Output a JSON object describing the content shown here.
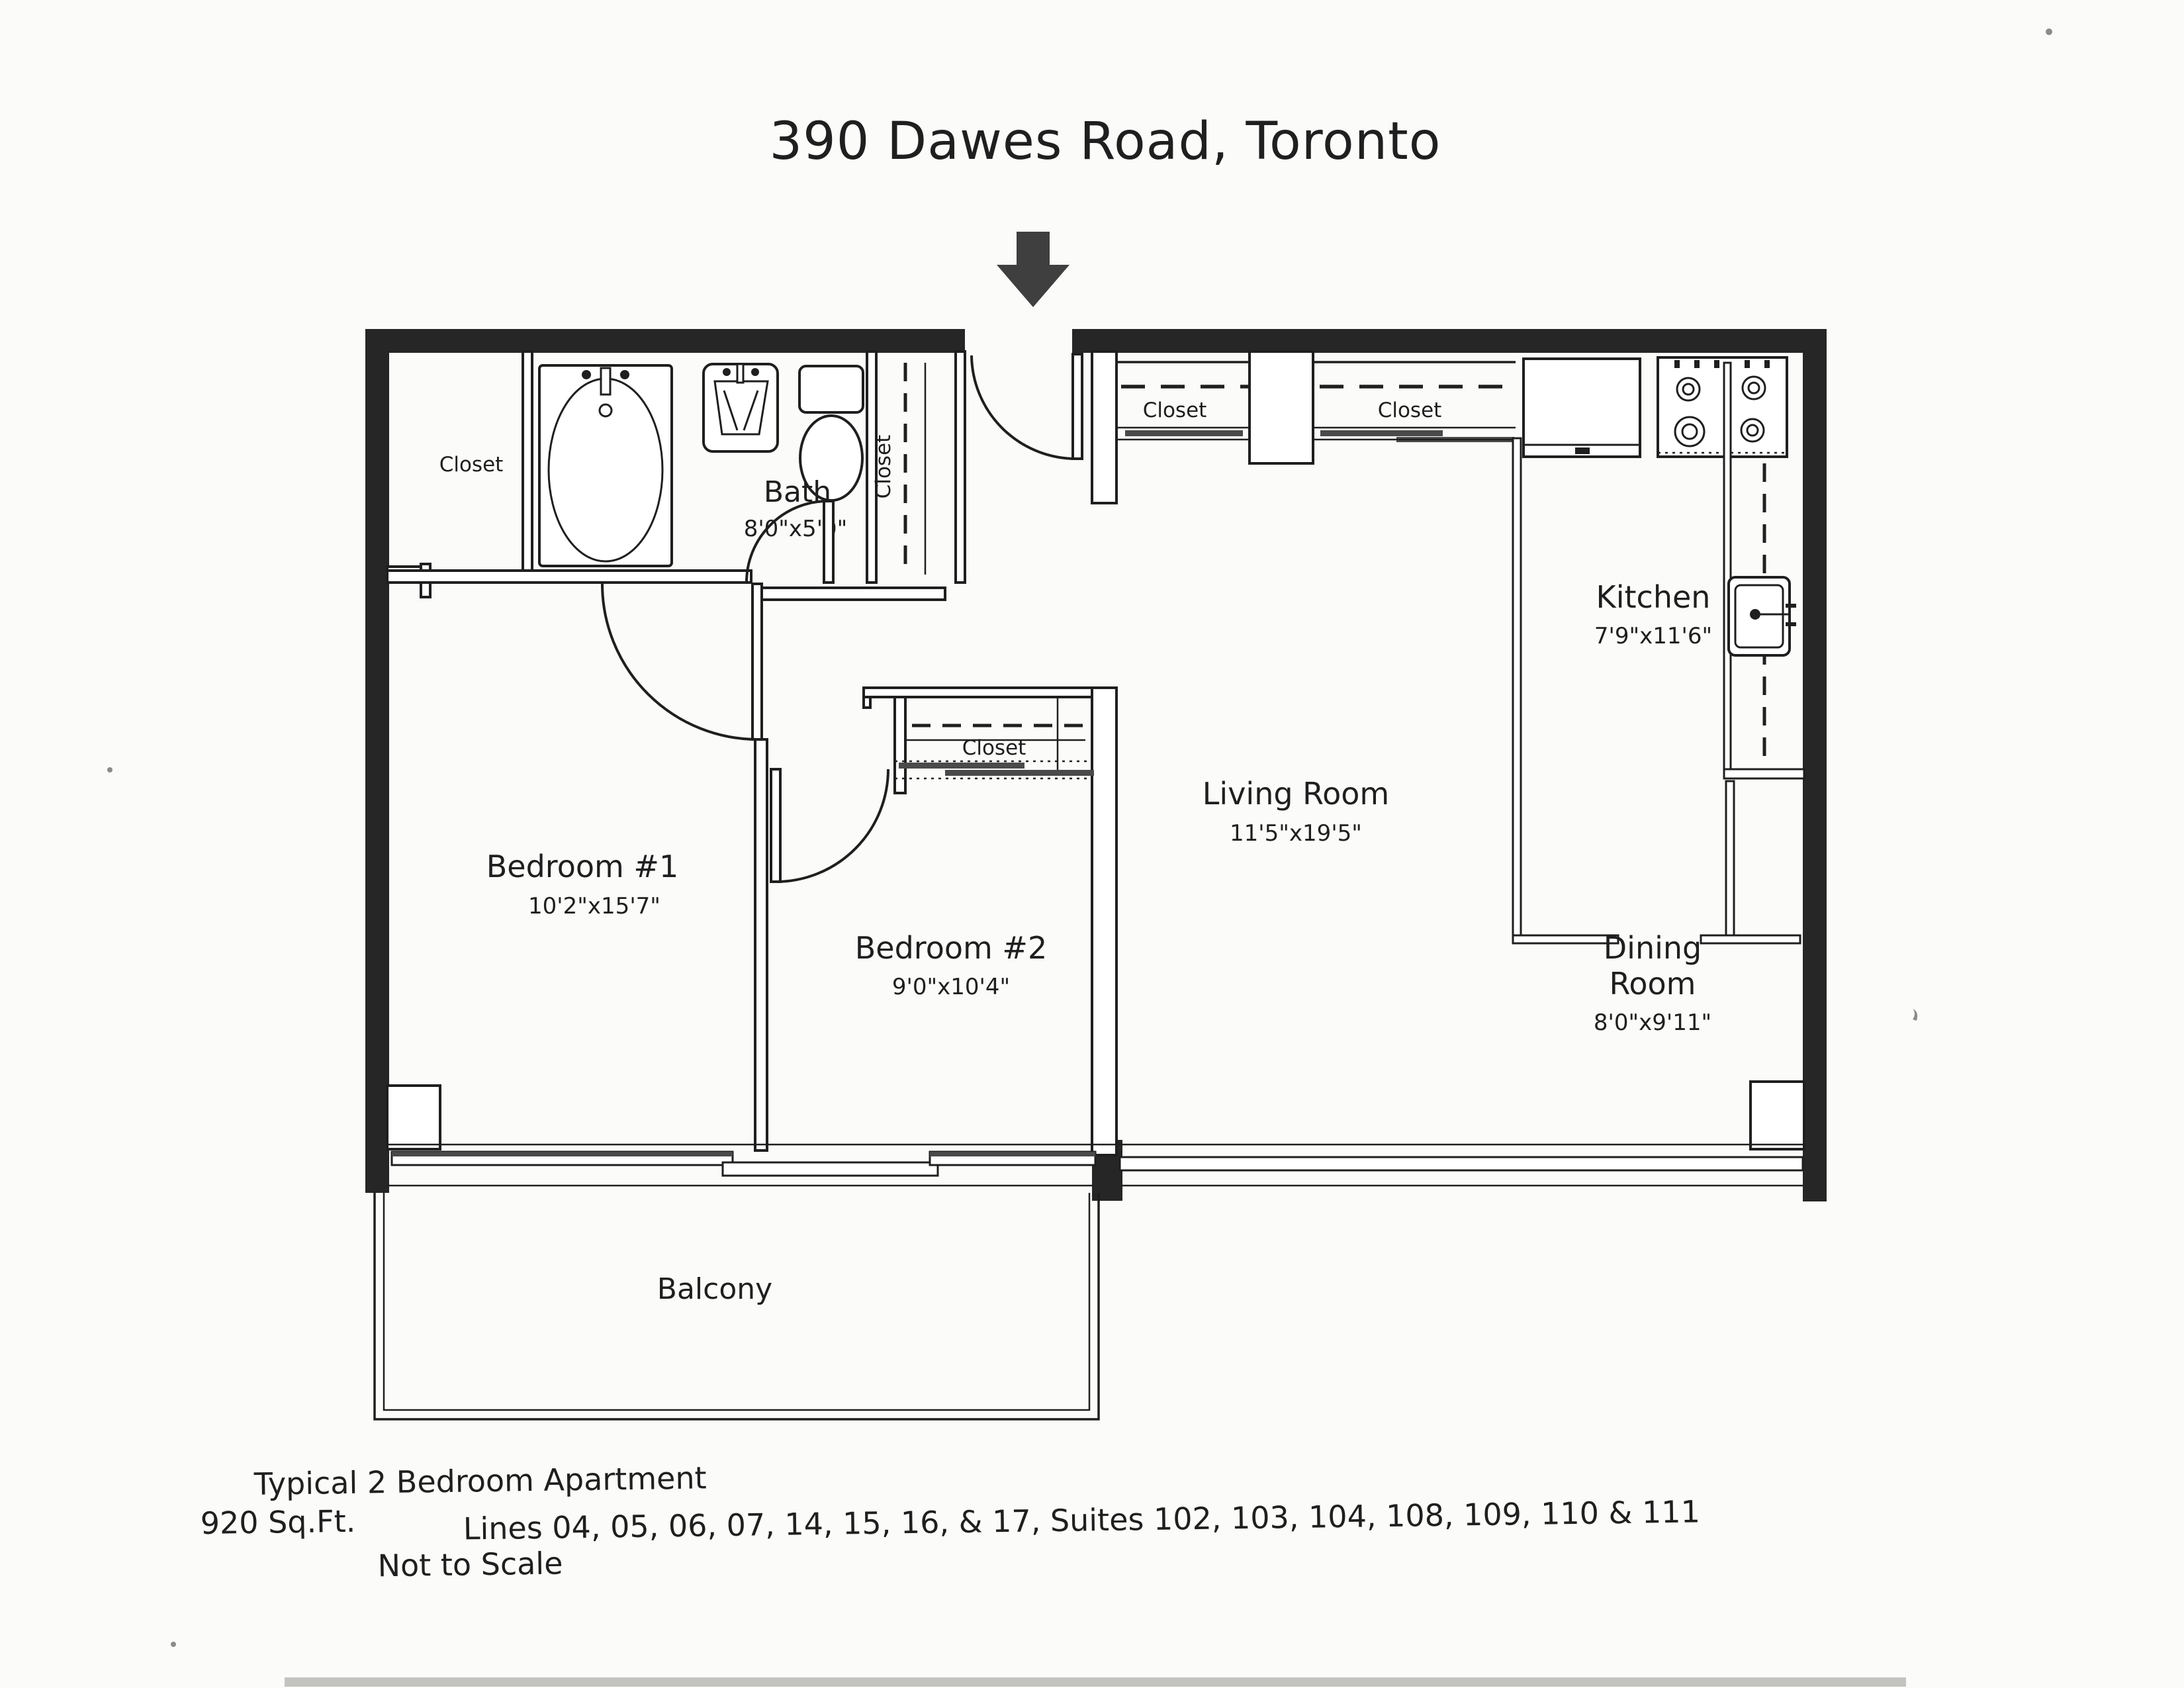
{
  "page": {
    "title": "390 Dawes Road, Toronto"
  },
  "rooms": {
    "bath": {
      "label": "Bath",
      "dims": "8'0\"x5'0\""
    },
    "kitchen": {
      "label": "Kitchen",
      "dims": "7'9\"x11'6\""
    },
    "living_room": {
      "label": "Living Room",
      "dims": "11'5\"x19'5\""
    },
    "dining_room": {
      "label_line1": "Dining",
      "label_line2": "Room",
      "dims": "8'0\"x9'11\""
    },
    "bedroom1": {
      "label": "Bedroom #1",
      "dims": "10'2\"x15'7\""
    },
    "bedroom2": {
      "label": "Bedroom #2",
      "dims": "9'0\"x10'4\""
    },
    "balcony": {
      "label": "Balcony"
    }
  },
  "closets": {
    "bedroom1_closet": "Closet",
    "linen_closet": "Closet",
    "hall_closet_left": "Closet",
    "hall_closet_right": "Closet",
    "bedroom2_closet": "Closet"
  },
  "footer": {
    "type_line": "Typical 2 Bedroom Apartment",
    "area_line": "920 Sq.Ft.",
    "units_line": "Lines 04, 05, 06, 07, 14, 15, 16, & 17, Suites 102, 103, 104, 108, 109, 110 & 111",
    "scale_line": "Not to Scale"
  },
  "colors": {
    "paper": "#fbfbf9",
    "ink": "#1f1f1f",
    "wall": "#262626",
    "arrow": "#3f3f3f",
    "track": "#4a4a4a"
  }
}
